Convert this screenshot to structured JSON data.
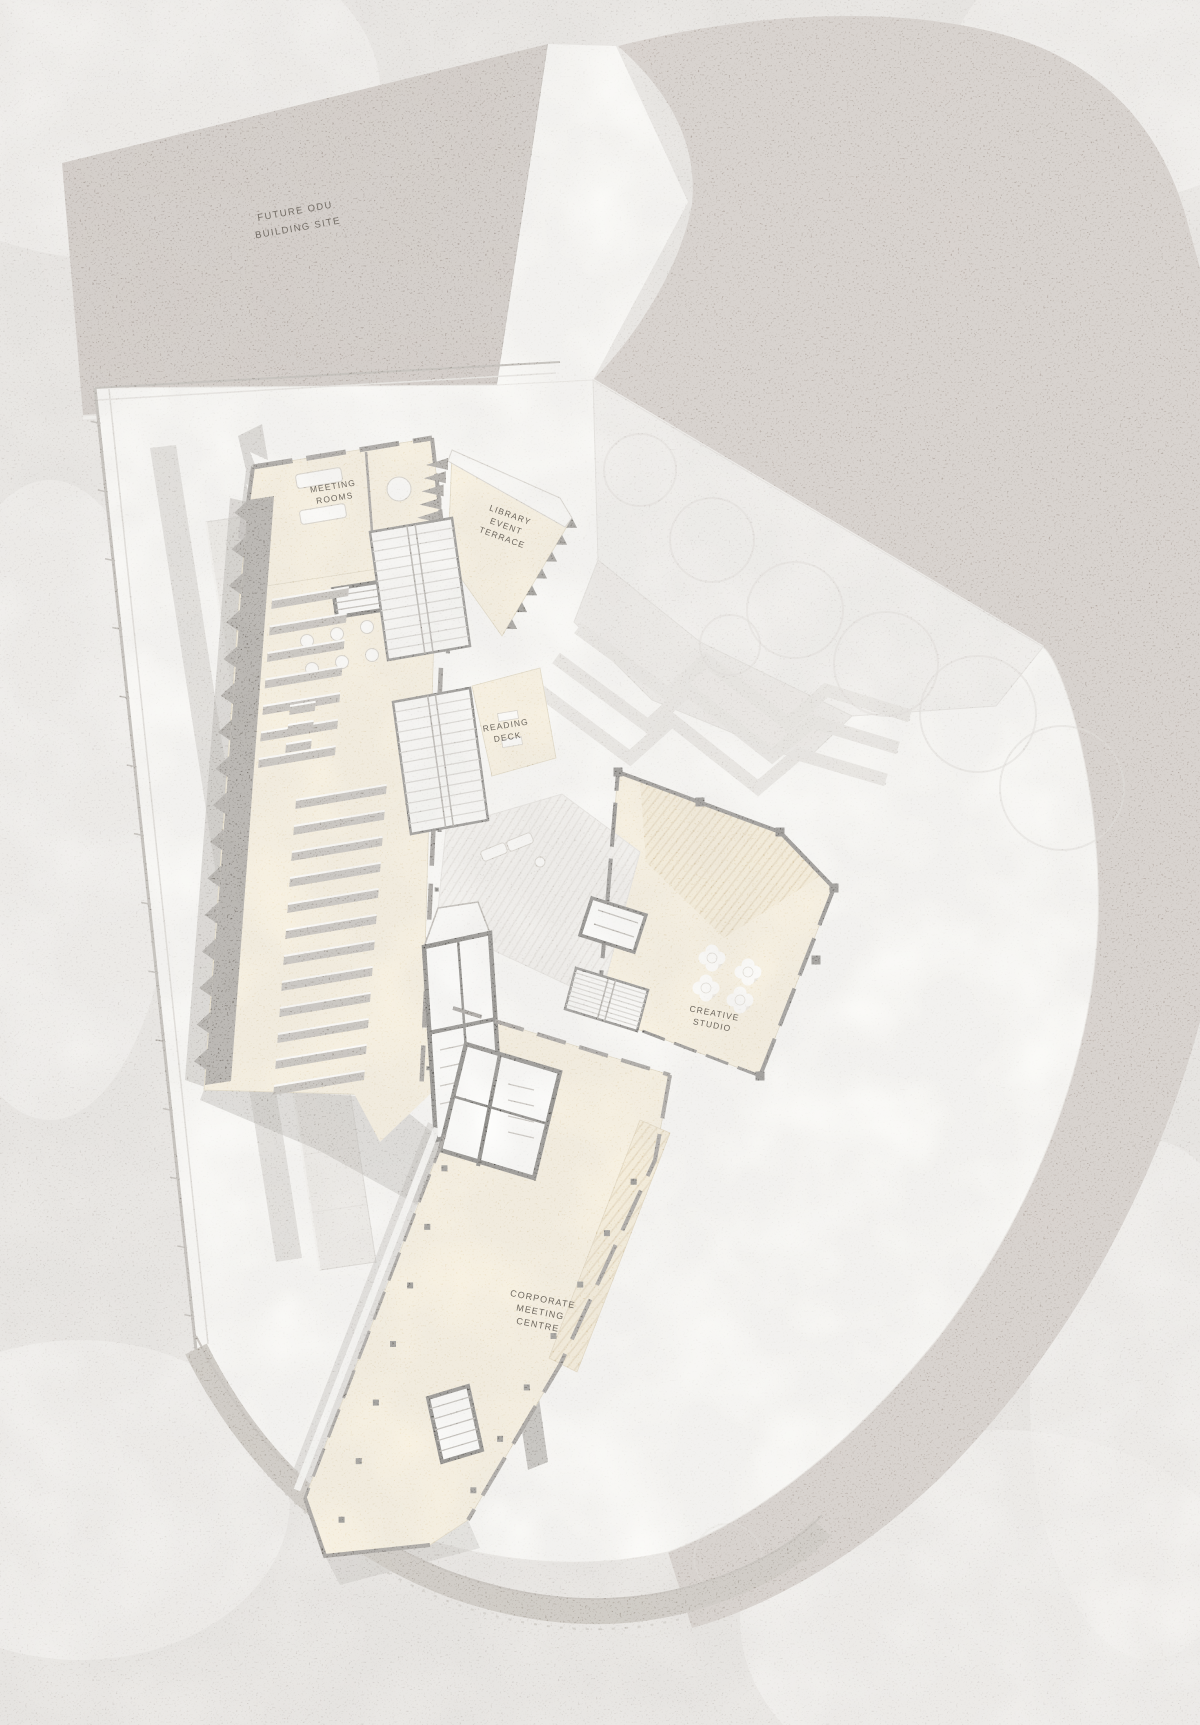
{
  "labels": {
    "future_site": {
      "line1": "FUTURE ODU",
      "line2": "BUILDING SITE"
    },
    "meeting_rooms": {
      "line1": "MEETING",
      "line2": "ROOMS"
    },
    "library_event_terrace": {
      "line1": "LIBRARY",
      "line2": "EVENT",
      "line3": "TERRACE"
    },
    "reading_deck": {
      "line1": "READING",
      "line2": "DECK"
    },
    "creative_studio": {
      "line1": "CREATIVE",
      "line2": "STUDIO"
    },
    "corporate_meeting_centre": {
      "line1": "CORPORATE",
      "line2": "MEETING",
      "line3": "CENTRE"
    }
  },
  "palette": {
    "background": "#d8d4d0",
    "paving": "#f7f6f3",
    "landscape": "#b3a8a1",
    "future_site": "#a89d96",
    "floor_cream": "#f3e6c9",
    "wall_dark": "#56504a",
    "wall_black": "#27241f",
    "shelf_gray": "#938c84",
    "shadow": "#6e6861",
    "street_band": "#a1998f",
    "plaza_gray": "#e9e6e2",
    "label_ink": "#5a544c"
  }
}
